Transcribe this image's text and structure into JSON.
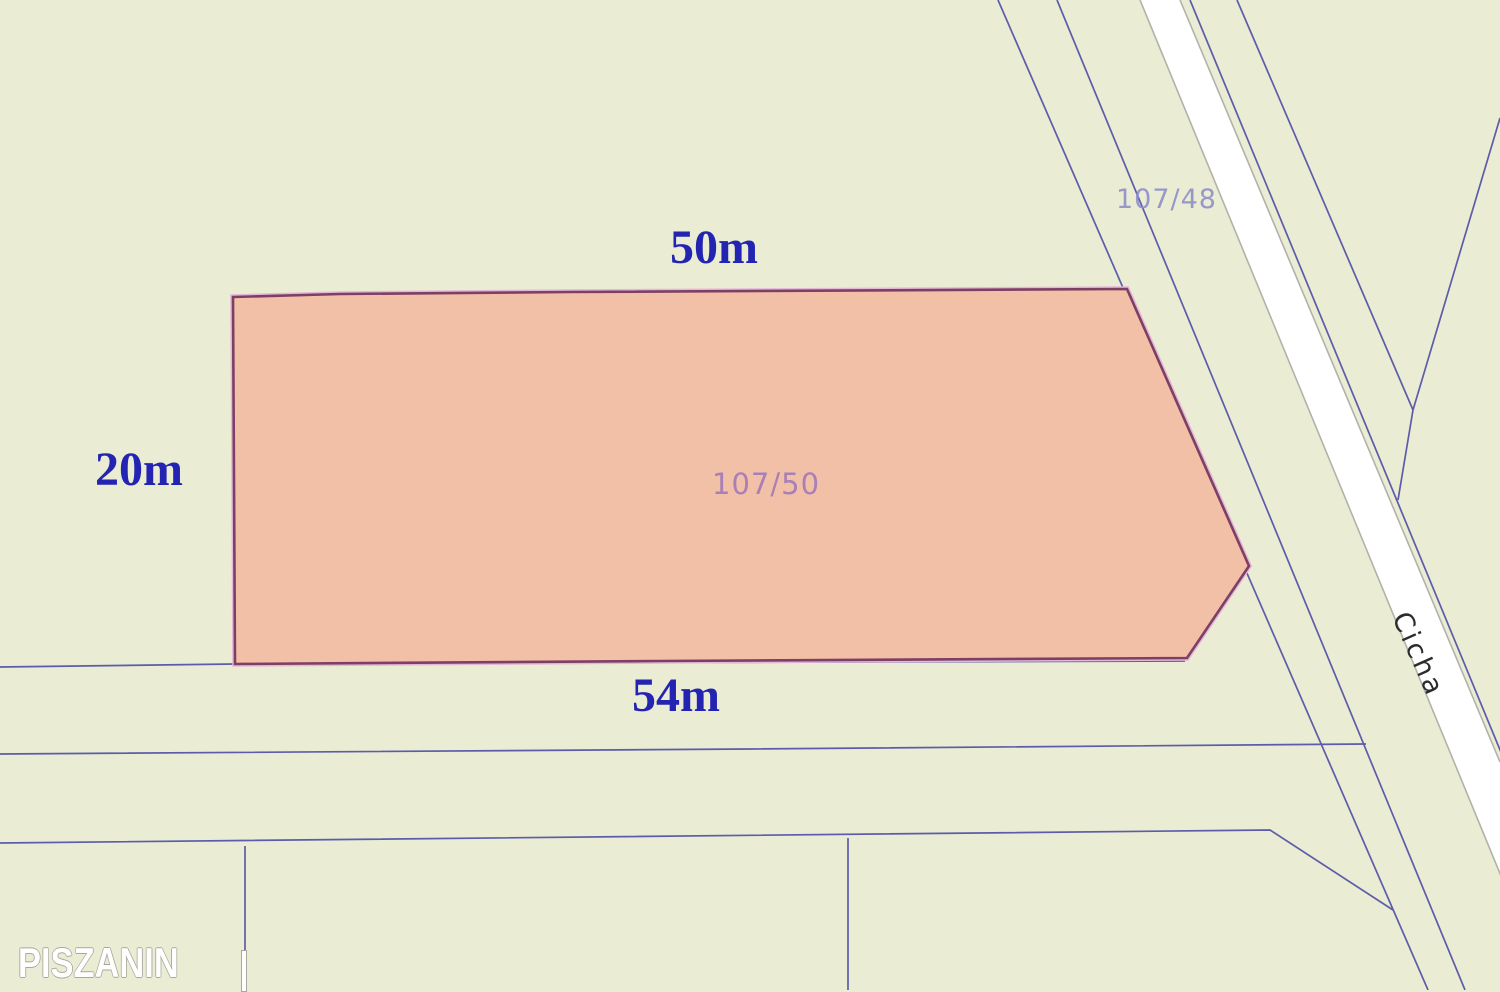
{
  "theme": {
    "bg": "#eaecd3",
    "parcel-fill": "#f2c0a6",
    "parcel-border": "#7d3f64",
    "parcel-halo": "#e3b7d8",
    "line-blue": "#5c5caa",
    "dim-text": "#2424b2",
    "parcel-label": "#a178b8",
    "adjacent-label": "#8f8fc6",
    "road-fill": "#ffffff",
    "road-edge": "#b2b2aa",
    "street-text": "#2b2b2b",
    "watermark-text": "#ffffff"
  },
  "map": {
    "main_parcel": {
      "label": "107/50",
      "top_dimension": "50m",
      "left_dimension": "20m",
      "bottom_dimension": "54m"
    },
    "adjacent_parcel": {
      "label": "107/48"
    },
    "street": {
      "name": "Cicha"
    },
    "watermark": "PISZANIN"
  }
}
